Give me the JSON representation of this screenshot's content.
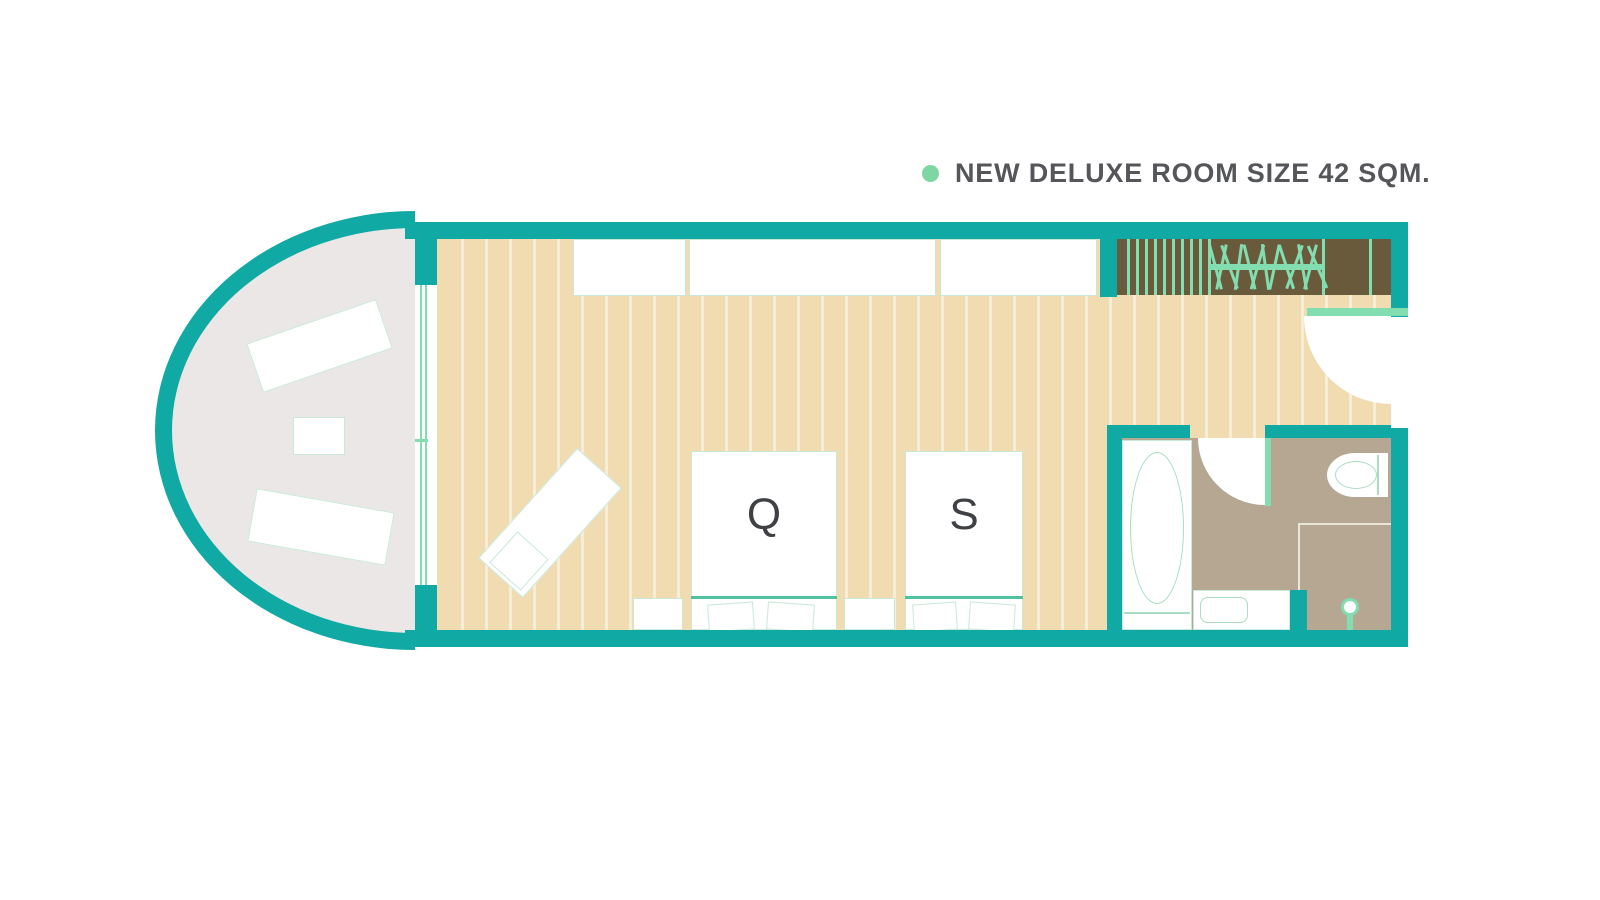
{
  "header": {
    "label": "NEW DELUXE ROOM SIZE 42 SQM.",
    "bullet_icon": "circle-dot"
  },
  "beds": {
    "queen_label": "Q",
    "single_label": "S"
  },
  "rooms": {
    "balcony": "balcony with two lounge chairs and side table",
    "bedroom": "bedroom with queen bed, single bed, chaise lounge, two nightstands, wall console",
    "closet": "wardrobe with shelves and clothes hangers",
    "bathroom": "bathroom with bathtub, toilet, sink vanity, shower area with drain",
    "entry": "entry door with swing arc"
  },
  "colors": {
    "wall": "#10a9a3",
    "floor": "#f1dcb1",
    "floor_stripe": "#f8eed8",
    "balcony_floor": "#ebe7e6",
    "closet": "#6a5a3c",
    "bathroom_floor": "#b5a791",
    "accent_green": "#82ddb0",
    "headboard_green": "#4fc3a0",
    "furniture_border": "#c9e9d8",
    "fixture_border": "#a9dcc2",
    "shower_line": "#e9e6d8",
    "bullet": "#7ed7a3",
    "text": "#55565a"
  }
}
